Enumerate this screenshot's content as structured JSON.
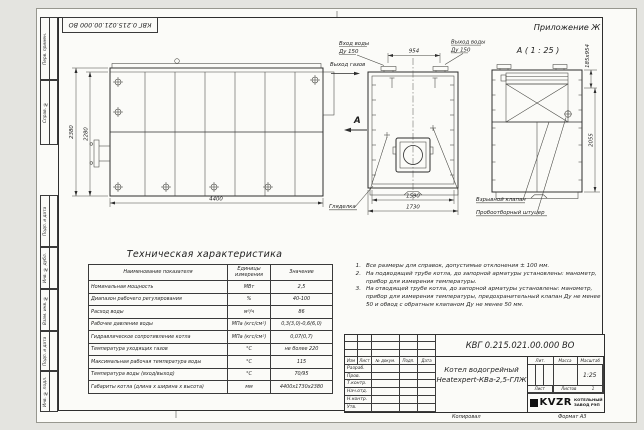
{
  "doc": {
    "number": "КВГ 0.215.021.00.000 ВО",
    "appendix": "Приложение Ж",
    "detail_view_label": "А ( 1 : 25 )",
    "copied_label": "Копировал",
    "format_label": "Формат А3"
  },
  "sidebar": {
    "labels": [
      "Перв. примен.",
      "Справ. №",
      "Подп. и дата",
      "Инв. № дубл.",
      "Взам. инв. №",
      "Подп. и дата",
      "Инв. № подл."
    ]
  },
  "drawing": {
    "labels": {
      "water_in_1": "Вход воды",
      "water_in_2": "Ду 150",
      "water_out_1": "Выход воды",
      "water_out_2": "Ду 150",
      "gas_out": "Выход газов",
      "section_arrow": "А",
      "peephole": "Гляделка",
      "explosion_valve": "Взрывной клапан",
      "sampling_fitting": "Пробоотборный штуцер"
    },
    "dims": {
      "side_height_outer": "2380",
      "side_height_inner": "2280",
      "side_length": "4400",
      "front_flange_span": "954",
      "front_width_inner": "1590",
      "front_width_outer": "1730",
      "section_flue": "185х954",
      "section_height": "2055"
    }
  },
  "table": {
    "title": "Техническая характеристика",
    "headers": [
      "Наименование показателя",
      "Единицы измерения",
      "Значение"
    ],
    "rows": [
      [
        "Номинальная мощность",
        "МВт",
        "2,5"
      ],
      [
        "Диапазон рабочего регулирования",
        "%",
        "40-100"
      ],
      [
        "Расход воды",
        "м³/ч",
        "86"
      ],
      [
        "Рабочее давление воды",
        "МПа (кгс/см²)",
        "0,3(3,0)-0,6(6,0)"
      ],
      [
        "Гидравлическое сопротивление котла",
        "МПа (кгс/см²)",
        "0,07(0,7)"
      ],
      [
        "Температура уходящих газов",
        "°С",
        "не более 220"
      ],
      [
        "Максимальная рабочая температура воды",
        "°С",
        "115"
      ],
      [
        "Температура воды (вход/выход)",
        "°С",
        "70/95"
      ],
      [
        "Габариты котла (длина х ширина х высота)",
        "мм",
        "4400х1730х2380"
      ]
    ]
  },
  "notes": {
    "items": [
      {
        "num": "1.",
        "text": "Все размеры для справок, допустимые отклонения ± 100 мм."
      },
      {
        "num": "2.",
        "text": "На подводящей трубе котла, до запорной арматуры установлены: манометр, прибор для измерения температуры."
      },
      {
        "num": "3.",
        "text": "На отводящей трубе котла, до запорной арматуры установлены: манометр, прибор для измерения температуры, предохранительный клапан Ду не менее 50 и обвод с обратным клапаном Ду не менее 50 мм."
      }
    ]
  },
  "titleblock": {
    "doc_number": "КВГ 0.215.021.00.000 ВО",
    "product_line1": "Котел водогрейный",
    "product_line2": "Heatexpert-КВа-2,5-ГЛЖ",
    "cols": [
      "Изм",
      "Лист",
      "№ докум.",
      "Подп.",
      "Дата"
    ],
    "rows": [
      "Разраб.",
      "Пров.",
      "Т.контр.",
      "Нач.отд.",
      "Н.контр.",
      "Утв."
    ],
    "lit_label": "Лит.",
    "mass_label": "Масса",
    "scale_label": "Масштаб",
    "scale_value": "1:25",
    "sheet_label": "Лист",
    "sheets_label": "Листов",
    "sheets_value": "1",
    "logo_text": "KVZR",
    "company_line1": "КОТЕЛЬНЫЙ",
    "company_line2": "ЗАВОД РЭП"
  }
}
